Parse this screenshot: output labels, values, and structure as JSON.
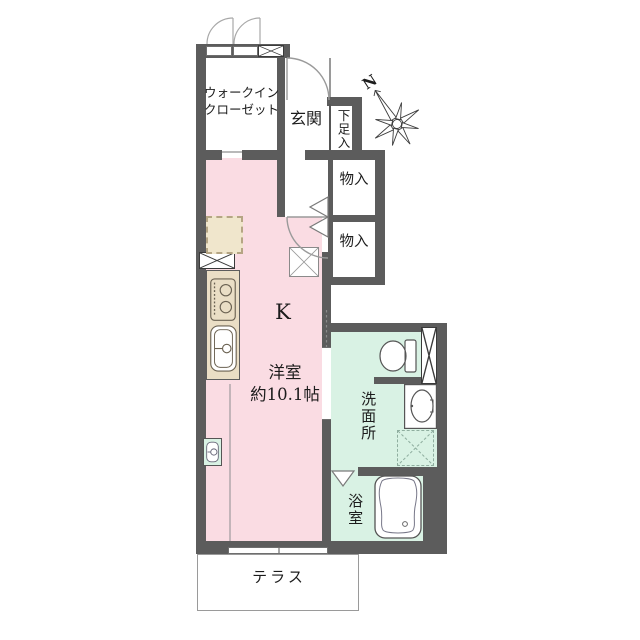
{
  "title": "apartment-floor-plan",
  "compass": {
    "north_label": "N"
  },
  "rooms": {
    "walk_in_closet": {
      "line1": "ウォークイン",
      "line2": "クローゼット"
    },
    "entrance": {
      "label": "玄関"
    },
    "shoe_storage": {
      "label": "下足入"
    },
    "storage_upper": {
      "label": "物入"
    },
    "storage_lower": {
      "label": "物入"
    },
    "kitchen": {
      "label": "K"
    },
    "main_room": {
      "line1": "洋室",
      "line2": "約10.1帖"
    },
    "washroom": {
      "label": "洗面所"
    },
    "bathroom": {
      "label": "浴室"
    },
    "terrace": {
      "label": "テラス"
    }
  },
  "colors": {
    "wall": "#5c5c5c",
    "room_pink": "#fadce3",
    "wet_area_mint": "#d9f2e4",
    "kitchen_counter": "#eadec5",
    "refrigerator_space": "#f0e6cc"
  }
}
